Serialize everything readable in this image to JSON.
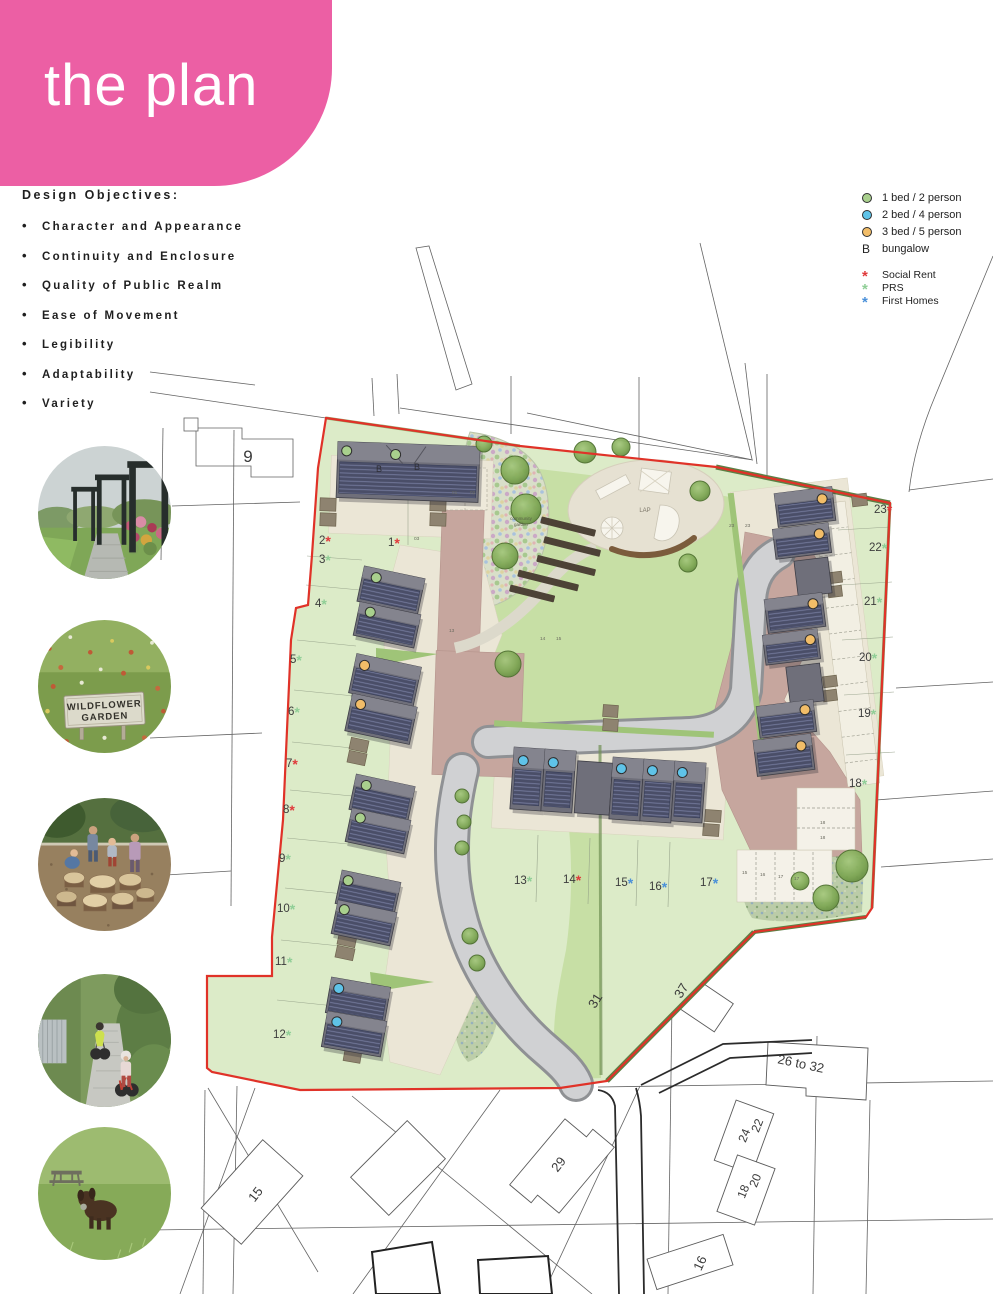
{
  "page": {
    "title": "the plan"
  },
  "objectives": {
    "heading": "Design Objectives:",
    "items": [
      "Character and Appearance",
      "Continuity and Enclosure",
      "Quality of Public Realm",
      "Ease of Movement",
      "Legibility",
      "Adaptability",
      "Variety"
    ]
  },
  "legend": {
    "unit_types": [
      {
        "label": "1 bed / 2 person",
        "color": "#a9d08d"
      },
      {
        "label": "2 bed / 4 person",
        "color": "#5fc3e8"
      },
      {
        "label": "3 bed / 5 person",
        "color": "#f2bd68"
      }
    ],
    "bungalow": {
      "symbol": "B",
      "label": "bungalow"
    },
    "tenures": [
      {
        "label": "Social Rent",
        "color": "#e0393b"
      },
      {
        "label": "PRS",
        "color": "#8fce96"
      },
      {
        "label": "First Homes",
        "color": "#4a90d9"
      }
    ]
  },
  "photos": {
    "wildflower_sign": {
      "line1": "WILDFLOWER",
      "line2": "GARDEN"
    }
  },
  "plan": {
    "area_labels": [
      {
        "t": "LAP",
        "x": 645,
        "y": 512,
        "s": 6,
        "c": "#7d776a"
      },
      {
        "t": "community",
        "x": 521,
        "y": 520,
        "s": 4.5,
        "c": "#5a6048"
      },
      {
        "t": "garden",
        "x": 521,
        "y": 526,
        "s": 4.5,
        "c": "#5a6048"
      }
    ],
    "context_labels": [
      {
        "t": "9",
        "x": 248,
        "y": 462,
        "s": 17,
        "r": 0
      },
      {
        "t": "31",
        "x": 599,
        "y": 1003,
        "s": 13,
        "r": -58
      },
      {
        "t": "37",
        "x": 685,
        "y": 993,
        "s": 13,
        "r": -58
      },
      {
        "t": "26 to 32",
        "x": 800,
        "y": 1068,
        "s": 13,
        "r": 12
      },
      {
        "t": "22",
        "x": 761,
        "y": 1127,
        "s": 12,
        "r": -68
      },
      {
        "t": "24",
        "x": 748,
        "y": 1137,
        "s": 12,
        "r": -68
      },
      {
        "t": "20",
        "x": 759,
        "y": 1182,
        "s": 12,
        "r": -68
      },
      {
        "t": "18",
        "x": 747,
        "y": 1193,
        "s": 12,
        "r": -68
      },
      {
        "t": "29",
        "x": 562,
        "y": 1167,
        "s": 13,
        "r": -52
      },
      {
        "t": "15",
        "x": 259,
        "y": 1197,
        "s": 13,
        "r": -52
      },
      {
        "t": "16",
        "x": 704,
        "y": 1265,
        "s": 13,
        "r": -65
      }
    ],
    "plots": [
      {
        "n": "1",
        "x": 388,
        "y": 546,
        "t": "social"
      },
      {
        "n": "2",
        "x": 319,
        "y": 544,
        "t": "social"
      },
      {
        "n": "3",
        "x": 319,
        "y": 563,
        "t": "prs"
      },
      {
        "n": "4",
        "x": 315,
        "y": 607,
        "t": "prs"
      },
      {
        "n": "5",
        "x": 290,
        "y": 663,
        "t": "prs"
      },
      {
        "n": "6",
        "x": 288,
        "y": 715,
        "t": "prs"
      },
      {
        "n": "7",
        "x": 286,
        "y": 767,
        "t": "social"
      },
      {
        "n": "8",
        "x": 283,
        "y": 813,
        "t": "social"
      },
      {
        "n": "9",
        "x": 279,
        "y": 862,
        "t": "prs"
      },
      {
        "n": "10",
        "x": 277,
        "y": 912,
        "t": "prs"
      },
      {
        "n": "11",
        "x": 275,
        "y": 965,
        "t": "prs"
      },
      {
        "n": "12",
        "x": 273,
        "y": 1038,
        "t": "prs"
      },
      {
        "n": "13",
        "x": 514,
        "y": 884,
        "t": "prs"
      },
      {
        "n": "14",
        "x": 563,
        "y": 883,
        "t": "social"
      },
      {
        "n": "15",
        "x": 615,
        "y": 886,
        "t": "first"
      },
      {
        "n": "16",
        "x": 649,
        "y": 890,
        "t": "first"
      },
      {
        "n": "17",
        "x": 700,
        "y": 886,
        "t": "first"
      },
      {
        "n": "18",
        "x": 849,
        "y": 787,
        "t": "prs"
      },
      {
        "n": "19",
        "x": 858,
        "y": 717,
        "t": "prs"
      },
      {
        "n": "20",
        "x": 859,
        "y": 661,
        "t": "prs"
      },
      {
        "n": "21",
        "x": 864,
        "y": 605,
        "t": "prs"
      },
      {
        "n": "22",
        "x": 869,
        "y": 551,
        "t": "prs"
      },
      {
        "n": "23",
        "x": 874,
        "y": 513,
        "t": "social"
      }
    ],
    "bays": [
      {
        "t": "01",
        "x": 452,
        "y": 494
      },
      {
        "t": "02",
        "x": 470,
        "y": 494
      },
      {
        "t": "03",
        "x": 414,
        "y": 540
      },
      {
        "t": "13",
        "x": 449,
        "y": 632
      },
      {
        "t": "14",
        "x": 540,
        "y": 640
      },
      {
        "t": "15",
        "x": 556,
        "y": 640
      },
      {
        "t": "23",
        "x": 729,
        "y": 527
      },
      {
        "t": "23",
        "x": 745,
        "y": 527
      },
      {
        "t": "15",
        "x": 742,
        "y": 874
      },
      {
        "t": "16",
        "x": 760,
        "y": 876
      },
      {
        "t": "17",
        "x": 778,
        "y": 878
      },
      {
        "t": "17",
        "x": 794,
        "y": 880
      },
      {
        "t": "18",
        "x": 820,
        "y": 824
      },
      {
        "t": "18",
        "x": 820,
        "y": 839
      }
    ],
    "house_letters": [
      {
        "t": "B",
        "x": 379,
        "y": 472
      },
      {
        "t": "B",
        "x": 417,
        "y": 470
      }
    ],
    "houses": [
      {
        "x": 337,
        "y": 444,
        "w": 142,
        "h": 56,
        "r": 2,
        "k": "b",
        "dots": [
          {
            "c": "g",
            "x": 9,
            "y": 9
          },
          {
            "c": "g",
            "x": 58,
            "y": 11
          }
        ]
      },
      {
        "x": 360,
        "y": 572,
        "w": 62,
        "h": 36,
        "r": 12,
        "dots": [
          {
            "c": "g",
            "x": 14,
            "y": 9
          }
        ]
      },
      {
        "x": 356,
        "y": 608,
        "w": 62,
        "h": 34,
        "r": 12,
        "dots": [
          {
            "c": "g",
            "x": 12,
            "y": 8
          }
        ]
      },
      {
        "x": 352,
        "y": 660,
        "w": 66,
        "h": 40,
        "r": 12,
        "dots": [
          {
            "c": "o",
            "x": 10,
            "y": 10
          }
        ]
      },
      {
        "x": 348,
        "y": 700,
        "w": 66,
        "h": 38,
        "r": 12,
        "dots": [
          {
            "c": "o",
            "x": 10,
            "y": 9
          }
        ]
      },
      {
        "x": 352,
        "y": 780,
        "w": 60,
        "h": 36,
        "r": 12,
        "dots": [
          {
            "c": "g",
            "x": 12,
            "y": 9
          }
        ]
      },
      {
        "x": 348,
        "y": 814,
        "w": 60,
        "h": 34,
        "r": 12,
        "dots": [
          {
            "c": "g",
            "x": 10,
            "y": 8
          }
        ]
      },
      {
        "x": 338,
        "y": 876,
        "w": 60,
        "h": 34,
        "r": 12,
        "dots": [
          {
            "c": "g",
            "x": 8,
            "y": 9
          }
        ]
      },
      {
        "x": 334,
        "y": 906,
        "w": 60,
        "h": 34,
        "r": 12,
        "dots": [
          {
            "c": "g",
            "x": 8,
            "y": 8
          }
        ]
      },
      {
        "x": 328,
        "y": 982,
        "w": 60,
        "h": 36,
        "r": 10,
        "dots": [
          {
            "c": "b",
            "x": 9,
            "y": 10
          }
        ]
      },
      {
        "x": 324,
        "y": 1016,
        "w": 60,
        "h": 36,
        "r": 10,
        "dots": [
          {
            "c": "b",
            "x": 11,
            "y": 9
          }
        ]
      },
      {
        "x": 512,
        "y": 748,
        "w": 31,
        "h": 62,
        "r": 4,
        "dots": [
          {
            "c": "b",
            "x": 10,
            "y": 13
          }
        ]
      },
      {
        "x": 543,
        "y": 750,
        "w": 31,
        "h": 62,
        "r": 4,
        "dots": [
          {
            "c": "b",
            "x": 9,
            "y": 13
          }
        ]
      },
      {
        "x": 576,
        "y": 762,
        "w": 35,
        "h": 52,
        "r": 4,
        "k": "p"
      },
      {
        "x": 611,
        "y": 758,
        "w": 31,
        "h": 62,
        "r": 4,
        "dots": [
          {
            "c": "b",
            "x": 9,
            "y": 11
          }
        ]
      },
      {
        "x": 642,
        "y": 760,
        "w": 31,
        "h": 62,
        "r": 4,
        "dots": [
          {
            "c": "b",
            "x": 9,
            "y": 11
          }
        ]
      },
      {
        "x": 673,
        "y": 762,
        "w": 31,
        "h": 60,
        "r": 4,
        "dots": [
          {
            "c": "b",
            "x": 8,
            "y": 11
          }
        ]
      },
      {
        "x": 776,
        "y": 490,
        "w": 58,
        "h": 34,
        "r": -7,
        "dots": [
          {
            "c": "o",
            "x": 47,
            "y": 11
          }
        ]
      },
      {
        "x": 774,
        "y": 526,
        "w": 56,
        "h": 30,
        "r": -7,
        "dots": [
          {
            "c": "o",
            "x": 46,
            "y": 10
          }
        ]
      },
      {
        "x": 796,
        "y": 559,
        "w": 34,
        "h": 36,
        "r": -7,
        "k": "p"
      },
      {
        "x": 766,
        "y": 596,
        "w": 58,
        "h": 34,
        "r": -7,
        "dots": [
          {
            "c": "o",
            "x": 48,
            "y": 10
          }
        ]
      },
      {
        "x": 764,
        "y": 632,
        "w": 55,
        "h": 30,
        "r": -7,
        "dots": [
          {
            "c": "o",
            "x": 47,
            "y": 10
          }
        ]
      },
      {
        "x": 788,
        "y": 665,
        "w": 34,
        "h": 38,
        "r": -7,
        "k": "p"
      },
      {
        "x": 758,
        "y": 703,
        "w": 57,
        "h": 32,
        "r": -7,
        "dots": [
          {
            "c": "o",
            "x": 48,
            "y": 9
          }
        ]
      },
      {
        "x": 755,
        "y": 737,
        "w": 58,
        "h": 36,
        "r": -7,
        "dots": [
          {
            "c": "o",
            "x": 47,
            "y": 11
          }
        ]
      }
    ],
    "trees": [
      [
        585,
        452,
        11
      ],
      [
        621,
        447,
        9
      ],
      [
        700,
        491,
        10
      ],
      [
        688,
        563,
        9
      ],
      [
        484,
        444,
        8
      ],
      [
        515,
        470,
        14
      ],
      [
        526,
        509,
        15
      ],
      [
        505,
        556,
        13
      ],
      [
        508,
        664,
        13
      ],
      [
        852,
        866,
        16
      ],
      [
        826,
        898,
        13
      ],
      [
        800,
        881,
        9
      ],
      [
        462,
        796,
        7
      ],
      [
        464,
        822,
        7
      ],
      [
        462,
        848,
        7
      ],
      [
        470,
        936,
        8
      ],
      [
        477,
        963,
        8
      ]
    ],
    "sheds": [
      [
        320,
        498,
        16,
        13,
        2
      ],
      [
        320,
        513,
        16,
        13,
        2
      ],
      [
        430,
        498,
        16,
        13,
        2
      ],
      [
        430,
        513,
        16,
        13,
        2
      ],
      [
        350,
        739,
        18,
        12,
        12
      ],
      [
        348,
        752,
        18,
        12,
        12
      ],
      [
        338,
        934,
        18,
        12,
        12
      ],
      [
        336,
        947,
        18,
        12,
        12
      ],
      [
        344,
        1050,
        17,
        12,
        10
      ],
      [
        852,
        494,
        15,
        12,
        -7
      ],
      [
        828,
        572,
        14,
        11,
        -7
      ],
      [
        828,
        586,
        14,
        11,
        -7
      ],
      [
        823,
        676,
        14,
        11,
        -7
      ],
      [
        823,
        690,
        14,
        11,
        -7
      ],
      [
        705,
        810,
        16,
        12,
        4
      ],
      [
        703,
        824,
        16,
        12,
        4
      ],
      [
        603,
        705,
        15,
        12,
        4
      ],
      [
        603,
        719,
        15,
        12,
        4
      ]
    ]
  },
  "colors": {
    "accent_pink": "#ec5fa4",
    "boundary_red": "#e03228",
    "social": "#e0393b",
    "prs": "#8fce96",
    "first": "#4a90d9",
    "dot_green": "#a9d08d",
    "dot_blue": "#5fc3e8",
    "dot_orange": "#f2bd68",
    "plot_text": "#3c3c3c"
  }
}
